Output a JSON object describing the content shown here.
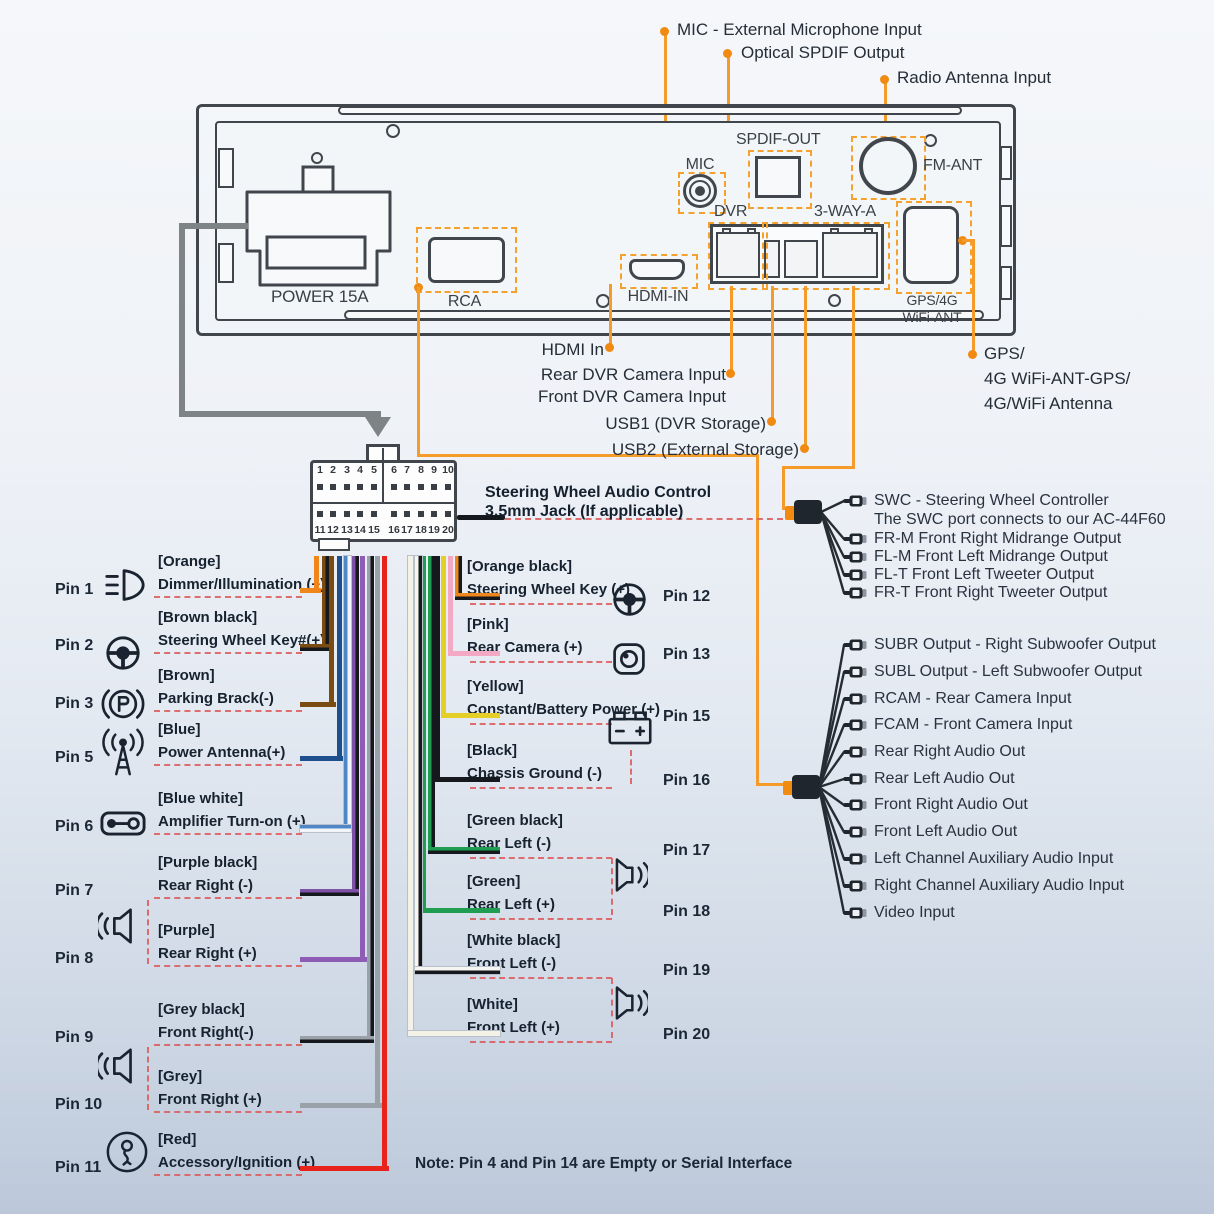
{
  "colors": {
    "accent_orange": "#F59B2A",
    "panel_line": "#41464D",
    "grey_cable": "#7E8386",
    "red_dash": "#DB5F5F",
    "text_dark": "#16222F"
  },
  "top_labels": {
    "mic": "MIC - External Microphone Input",
    "spdif": "Optical SPDIF Output",
    "radio": "Radio Antenna Input"
  },
  "panel_ports": {
    "power": "POWER 15A",
    "rca": "RCA",
    "mic": "MIC",
    "spdif": "SPDIF-OUT",
    "fm": "FM-ANT",
    "dvr": "DVR",
    "three_way": "3-WAY-A",
    "hdmi": "HDMI-IN",
    "gps_line1": "GPS/4G",
    "gps_line2": "WiFi-ANT"
  },
  "breakout_labels": {
    "hdmi": "HDMI In",
    "rear_dvr": "Rear DVR Camera Input",
    "front_dvr": "Front DVR Camera Input",
    "usb1": "USB1 (DVR Storage)",
    "usb2": "USB2 (External Storage)",
    "gps": [
      "GPS/",
      "4G WiFi-ANT-GPS/",
      "4G/WiFi Antenna"
    ]
  },
  "harness_connector": {
    "pins_top": [
      "1",
      "2",
      "3",
      "4",
      "5",
      "6",
      "7",
      "8",
      "9",
      "10"
    ],
    "pins_bottom": [
      "11",
      "12",
      "13",
      "14",
      "15",
      "16",
      "17",
      "18",
      "19",
      "20"
    ],
    "swc_jack_line1": "Steering Wheel Audio Control",
    "swc_jack_line2": "3.5mm Jack (If applicable)"
  },
  "left_pins": [
    {
      "pin": "Pin 1",
      "color_name": "[Orange]",
      "function": "Dimmer/Illumination (+)",
      "icon": "headlight-icon",
      "wire": "#EE861C"
    },
    {
      "pin": "Pin 2",
      "color_name": "[Brown black]",
      "function": "Steering Wheel Key#(+)",
      "icon": "steering-wheel-icon",
      "wire": "#7A4B13",
      "wire2": "#15181C"
    },
    {
      "pin": "Pin 3",
      "color_name": "[Brown]",
      "function": "Parking Brack(-)",
      "icon": "parking-brake-icon",
      "wire": "#7A4B13"
    },
    {
      "pin": "Pin 5",
      "color_name": "[Blue]",
      "function": "Power Antenna(+)",
      "icon": "antenna-icon",
      "wire": "#1C4F8C"
    },
    {
      "pin": "Pin 6",
      "color_name": "[Blue white]",
      "function": "Amplifier Turn-on (+)",
      "icon": "amplifier-icon",
      "wire": "#4E86C8",
      "wire2": "#F2F5F9",
      "outline": true
    },
    {
      "pin": "Pin 7",
      "color_name": "[Purple black]",
      "function": "Rear Right (-)",
      "icon": "speaker-icon",
      "wire": "#7C51A6",
      "wire2": "#15181C"
    },
    {
      "pin": "Pin 8",
      "color_name": "[Purple]",
      "function": "Rear Right (+)",
      "icon": "speaker-icon",
      "wire": "#8E5BB5"
    },
    {
      "pin": "Pin 9",
      "color_name": "[Grey black]",
      "function": "Front Right(-)",
      "icon": "speaker-icon",
      "wire": "#9BA1A9",
      "wire2": "#15181C"
    },
    {
      "pin": "Pin 10",
      "color_name": "[Grey]",
      "function": "Front Right (+)",
      "icon": "speaker-icon",
      "wire": "#9BA1A9"
    },
    {
      "pin": "Pin 11",
      "color_name": "[Red]",
      "function": "Accessory/Ignition (+)",
      "icon": "ignition-key-icon",
      "wire": "#E8231B"
    }
  ],
  "right_pins": [
    {
      "pin": "Pin 12",
      "color_name": "[Orange black]",
      "function": "Steering Wheel Key (+)",
      "icon": "steering-wheel-icon",
      "wire": "#EE861C",
      "wire2": "#15181C"
    },
    {
      "pin": "Pin 13",
      "color_name": "[Pink]",
      "function": "Rear Camera (+)",
      "icon": "camera-icon",
      "wire": "#F3A8C4"
    },
    {
      "pin": "Pin 15",
      "color_name": "[Yellow]",
      "function": "Constant/Battery Power (+)",
      "icon": "battery-icon",
      "wire": "#E5CE25"
    },
    {
      "pin": "Pin 16",
      "color_name": "[Black]",
      "function": "Chassis Ground (-)",
      "icon": "battery-icon",
      "wire": "#15181C"
    },
    {
      "pin": "Pin 17",
      "color_name": "[Green black]",
      "function": "Rear Left (-)",
      "icon": "speaker-icon",
      "wire": "#1F9E51",
      "wire2": "#15181C"
    },
    {
      "pin": "Pin 18",
      "color_name": "[Green]",
      "function": "Rear Left (+)",
      "icon": "speaker-icon",
      "wire": "#1F9E51"
    },
    {
      "pin": "Pin 19",
      "color_name": "[White black]",
      "function": "Front Left (-)",
      "icon": "speaker-icon",
      "wire": "#F6F5EF",
      "wire2": "#15181C",
      "outline": true
    },
    {
      "pin": "Pin 20",
      "color_name": "[White]",
      "function": "Front Left (+)",
      "icon": "speaker-icon",
      "wire": "#F4F2E6",
      "outline": true
    }
  ],
  "swc_harness": [
    {
      "label": "SWC - Steering Wheel Controller",
      "sub": "The SWC port connects to our AC-44F60"
    },
    {
      "label": "FR-M Front Right Midrange Output"
    },
    {
      "label": "FL-M Front Left Midrange Output"
    },
    {
      "label": "FL-T Front Left Tweeter Output"
    },
    {
      "label": "FR-T Front Right Tweeter Output"
    }
  ],
  "av_harness": [
    {
      "label": "SUBR Output - Right Subwoofer Output"
    },
    {
      "label": "SUBL Output - Left Subwoofer Output"
    },
    {
      "label": "RCAM - Rear Camera Input"
    },
    {
      "label": "FCAM - Front Camera Input"
    },
    {
      "label": "Rear Right Audio Out"
    },
    {
      "label": "Rear Left Audio Out"
    },
    {
      "label": "Front Right Audio Out"
    },
    {
      "label": "Front Left Audio Out"
    },
    {
      "label": "Left Channel Auxiliary Audio Input"
    },
    {
      "label": "Right Channel Auxiliary Audio Input"
    },
    {
      "label": "Video Input"
    }
  ],
  "note": "Note: Pin 4 and Pin 14 are Empty or Serial Interface"
}
